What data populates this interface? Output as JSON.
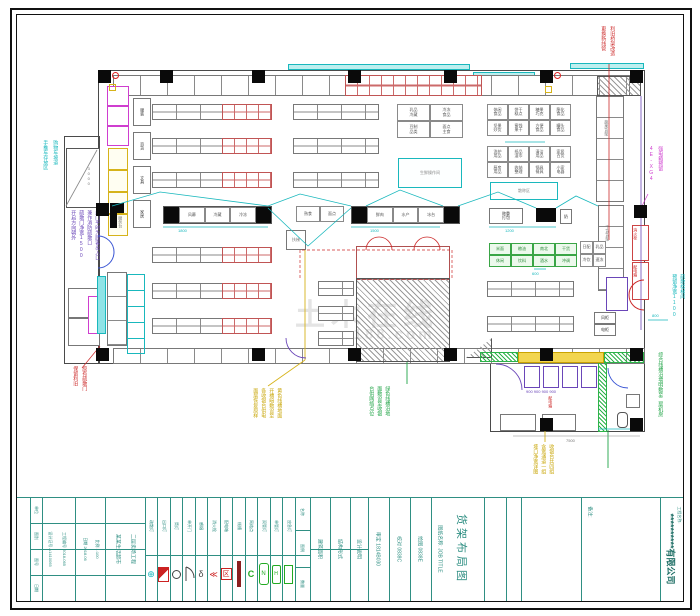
{
  "plan": {
    "cyan_left_note": [
      "购物车坡道",
      "手推车存放区"
    ],
    "door_note": [
      "此门平时为顾客出入口",
      "兼作消防疏散口",
      "疏散门净宽1500",
      "开启方向朝外"
    ],
    "red_left_note": [
      "原有疏散门",
      "保留利旧"
    ],
    "red_top_note": [
      "利旧桥架改造",
      "更换新线管"
    ],
    "magenta_right_note": [
      "强电箱预留",
      "4E-XG4"
    ],
    "cyan_door_note": [
      "疏散楼梯间",
      "预留净宽1100"
    ],
    "yellow_note_c": [
      "黄色线槽地面",
      "开槽暗敷设至",
      "各收银台供电",
      "面层恢复原样"
    ],
    "green_note_c": [
      "绿色线槽沿地",
      "面敷设至收银",
      "台供网络点位"
    ],
    "yellow_note_r": [
      "收银台共四组",
      "含宽通道一组",
      "垭口净宽详图"
    ],
    "green_note_r": "综合线槽沿墙明敷至二层机房",
    "red_annex_note": "配电箱",
    "service_label": "服务台",
    "label_boxes": [
      "服装",
      "百货",
      "文具",
      "家居"
    ],
    "island1_cells": [
      "风幕",
      "冷藏",
      "冷冻"
    ],
    "island2_cells": [
      "熟食",
      "面点"
    ],
    "island3_cells": [
      "鲜肉",
      "水产",
      "冰台"
    ],
    "island5_label": "称重\n打包",
    "island5_small": "奶",
    "escalator_box": "扶梯",
    "clusterA": [
      "休闲\n食品",
      "饼干\n糕点",
      "糖果\n巧克",
      "膨化\n食品",
      "坚果\n炒货",
      "蜜饯\n果干",
      "方便\n食品",
      "罐头\n食品"
    ],
    "clusterB": [
      "洗护\n用品",
      "纸品\n湿巾",
      "清洁\n用品",
      "家居\n百货",
      "厨房\n用品",
      "收纳\n整理",
      "锅具\n餐具",
      "小家\n电器"
    ],
    "midTable": [
      "乳品\n冷藏",
      "冷冻\n食品",
      "豆制\n品类",
      "面点\n主食"
    ],
    "green_table": [
      "米面",
      "粮油",
      "南北",
      "干货",
      "休闲",
      "饮料",
      "酒水",
      "冲调"
    ],
    "attach_table": [
      "日配",
      "乳品",
      "冷饮",
      "速冻"
    ],
    "box_kg_a": "生鲜操作间",
    "box_kg_b": "散称区",
    "right_shelf_a": "蔬果货架",
    "right_shelf_b": "干货货架",
    "red_wall_boxes": [
      "消火栓",
      "配电箱"
    ],
    "small_boxes": [
      "风柜",
      "电柜"
    ],
    "checkout_dims": "900  900  900  900",
    "dims": {
      "d1": "1800",
      "d2": "1500",
      "d3": "1200",
      "d4": "800",
      "d5": "600",
      "d6": "7500",
      "d7": "3000"
    },
    "watermark_a": "土木在线",
    "watermark_b": "co188.com"
  },
  "titleblock": {
    "company": "**********有限公司",
    "project_label": "工程名称:",
    "note_label": "备注:",
    "job_title_label": "图纸名称: JOB TITLE",
    "drawing_title": "货架布局图",
    "approve": "审定 1814B030",
    "check": "校对 0838C",
    "draw": "绘图 0838E",
    "area_label": "建筑面积",
    "struct_label": "结构形式",
    "desc_label": "设计说明",
    "header_name": "名称",
    "header_sym": "图例",
    "header_qty": "数量",
    "info_col1": [
      "单位",
      "图别",
      "图号",
      "日期"
    ],
    "info_col2": [
      "设计证号 A1410065",
      "工程编号 2018-065"
    ],
    "info_col3": [
      "日期 2018.06",
      "比例 1:100"
    ],
    "info_col4": [
      "某某生活超市",
      "二层卖场工程"
    ],
    "legend_names": [
      "疏散灯",
      "出口灯",
      "筒灯",
      "单开门",
      "感烟",
      "消火栓",
      "配电箱",
      "线槽",
      "网络点",
      "双管灯",
      "单管灯",
      "应急灯"
    ]
  }
}
